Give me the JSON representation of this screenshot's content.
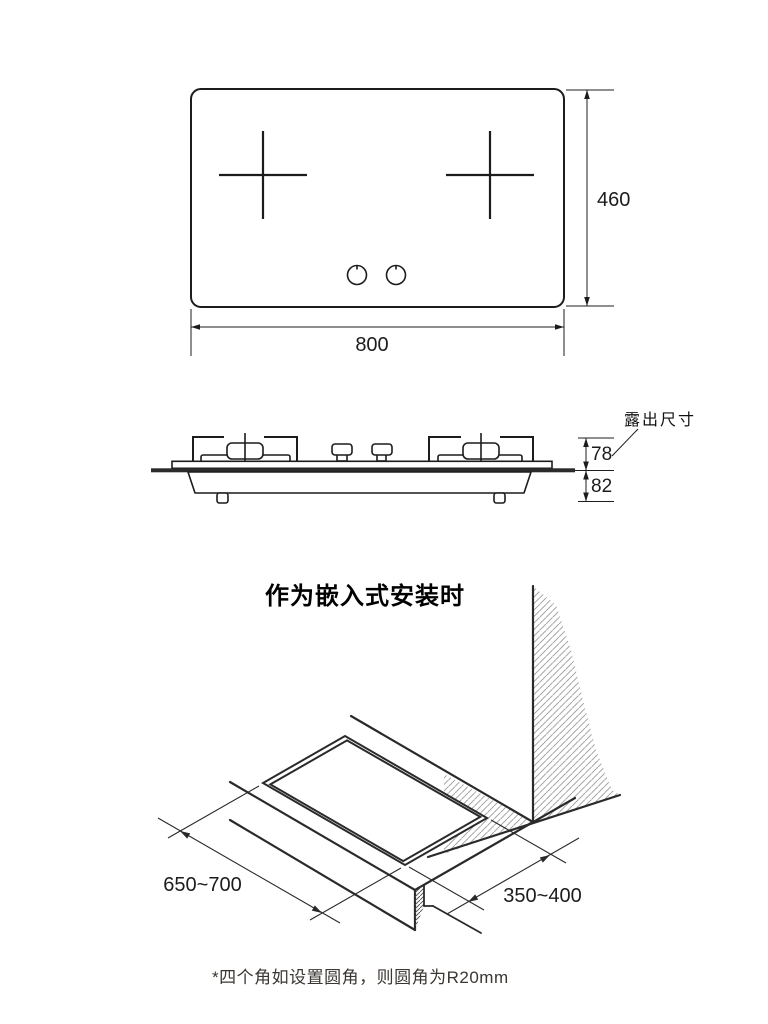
{
  "top_view": {
    "width_label": "800",
    "height_label": "460"
  },
  "side_view": {
    "exposed_label": "露出尺寸",
    "above_counter_label": "78",
    "below_counter_label": "82"
  },
  "install_view": {
    "title": "作为嵌入式安装时",
    "cutout_depth_label": "650~700",
    "cutout_width_label": "350~400",
    "note": "*四个角如设置圆角，则圆角为R20mm"
  }
}
